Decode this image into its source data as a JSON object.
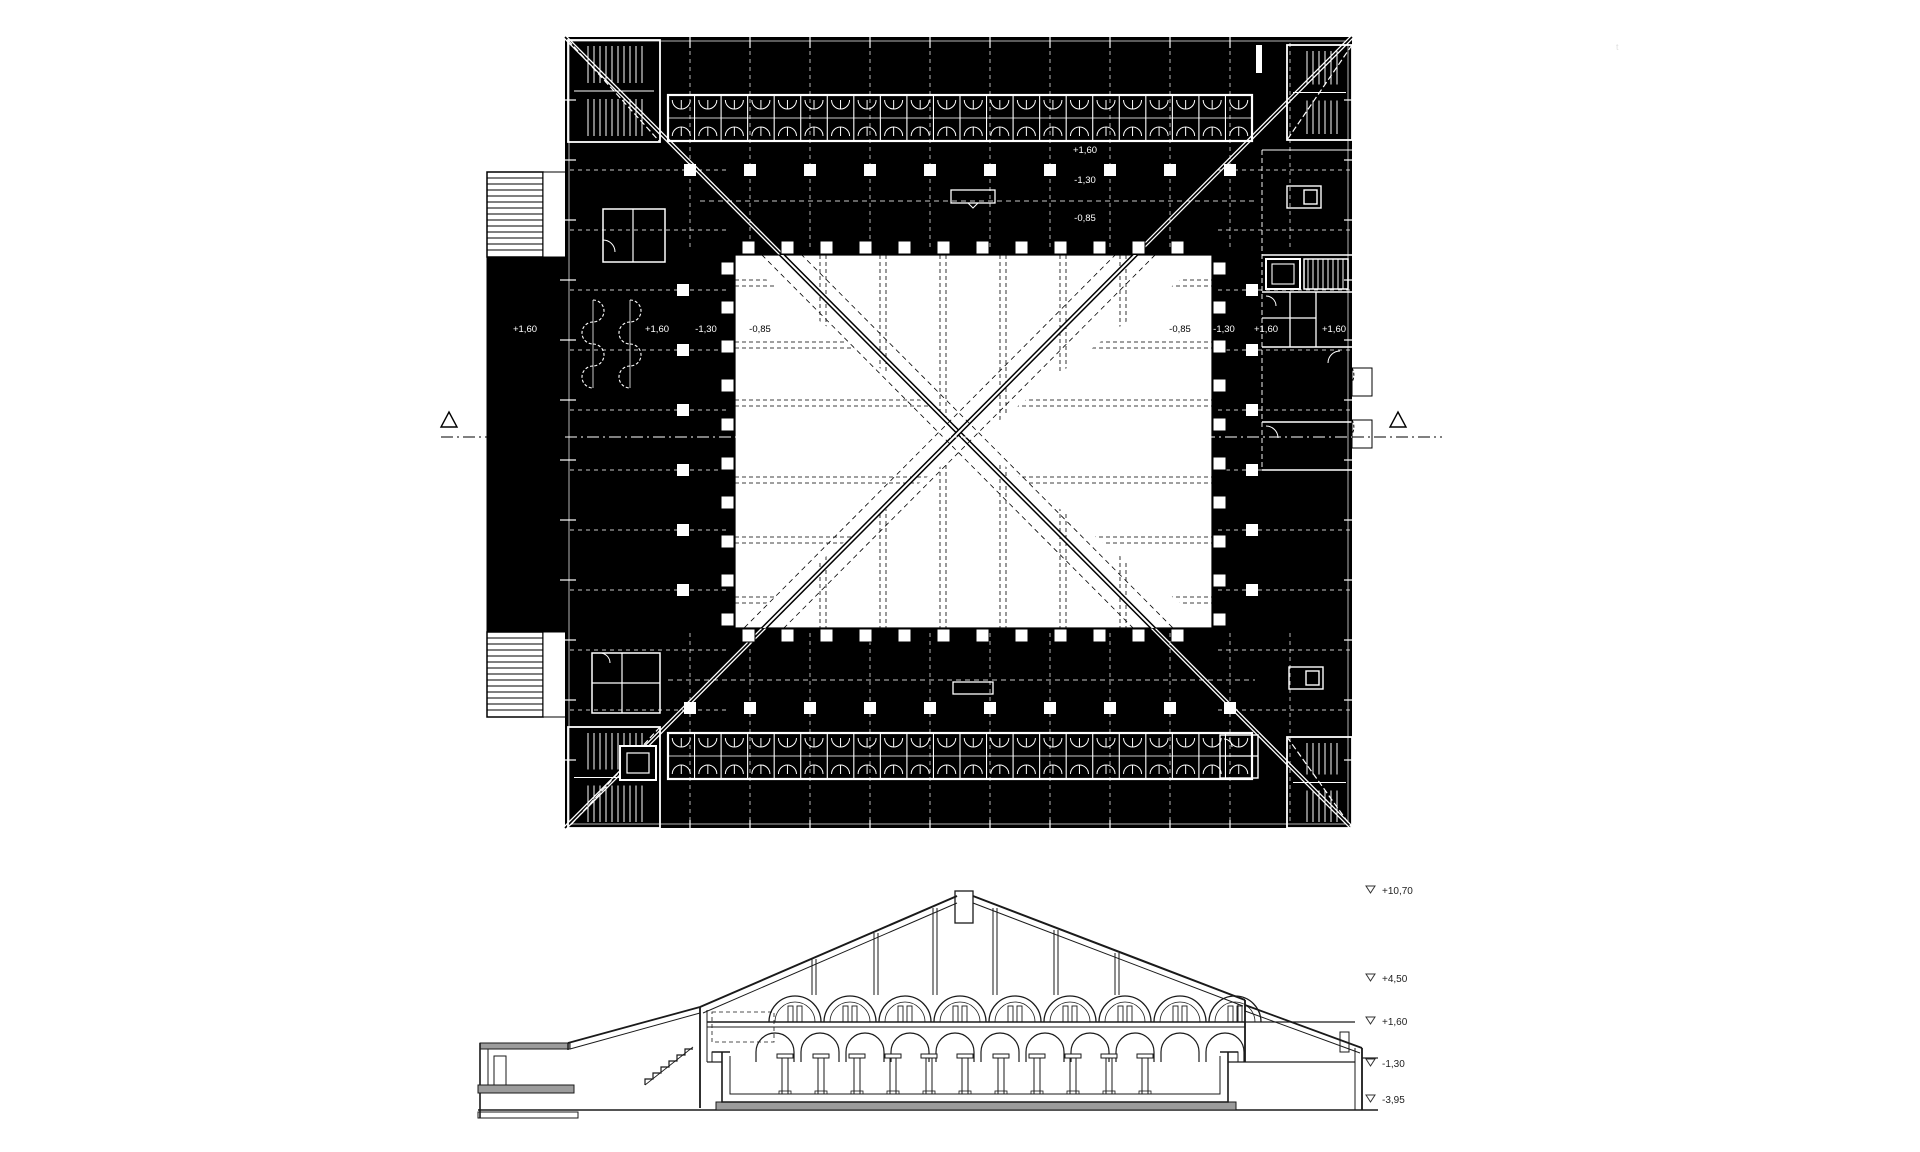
{
  "sheet": {
    "kind": "architectural drawing — floor plan with central courtyard and building cross-section",
    "colors": {
      "ink": "#000000",
      "paper": "#ffffff",
      "line": "#ffffff",
      "slab_gray": "#9c9c9c"
    },
    "plan": {
      "labels": [
        {
          "text": "+1,60",
          "x": 525,
          "y": 332,
          "on": "dark"
        },
        {
          "text": "+1,60",
          "x": 657,
          "y": 332,
          "on": "dark"
        },
        {
          "text": "-1,30",
          "x": 706,
          "y": 332,
          "on": "dark"
        },
        {
          "text": "-0,85",
          "x": 760,
          "y": 332,
          "on": "light"
        },
        {
          "text": "-0,85",
          "x": 1180,
          "y": 332,
          "on": "light"
        },
        {
          "text": "-1,30",
          "x": 1224,
          "y": 332,
          "on": "dark"
        },
        {
          "text": "+1,60",
          "x": 1266,
          "y": 332,
          "on": "dark"
        },
        {
          "text": "+1,60",
          "x": 1334,
          "y": 332,
          "on": "dark"
        },
        {
          "text": "+1,60",
          "x": 1085,
          "y": 153,
          "on": "dark"
        },
        {
          "text": "-1,30",
          "x": 1085,
          "y": 183,
          "on": "dark"
        },
        {
          "text": "-0,85",
          "x": 1085,
          "y": 221,
          "on": "dark"
        }
      ],
      "section_cut_markers": {
        "left": "triangle",
        "right": "triangle"
      }
    },
    "section": {
      "level_markers": [
        {
          "text": "+10,70",
          "y": 891
        },
        {
          "text": "+4,50",
          "y": 979
        },
        {
          "text": "+1,60",
          "y": 1022
        },
        {
          "text": "-1,30",
          "y": 1064
        },
        {
          "text": "-3,95",
          "y": 1100
        }
      ]
    },
    "artifact": {
      "text": "t",
      "x": 1616,
      "y": 50
    }
  }
}
